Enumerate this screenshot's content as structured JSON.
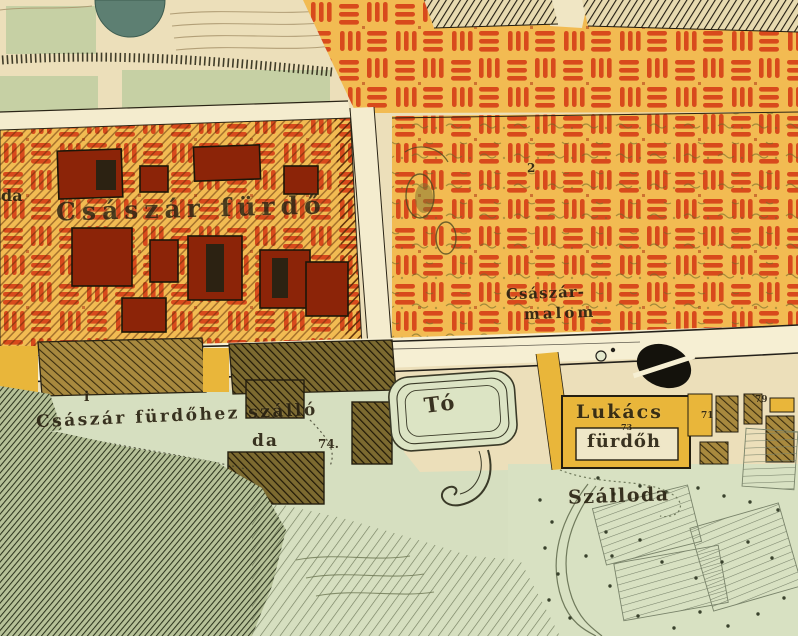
{
  "map": {
    "type": "historical-city-map",
    "labels": {
      "partial_left": "da",
      "csaszar_furdo": "Császár fürdő",
      "malom_line1": "Császár-",
      "malom_line2": "malom",
      "hotel_line1": "Császár fürdőhez szálló",
      "hotel_line2": "da",
      "hotel_parcel_number": "74.",
      "pond": "Tó",
      "lukacs_line1": "Lukács",
      "lukacs_line2": "fürdőh",
      "lukacs_parcel_number": "73",
      "szalloda": "Szálloda",
      "parcel_number_2": "2",
      "parcel_number_71": "71",
      "parcel_number_79": "79",
      "info_marker": "i"
    },
    "colors": {
      "paper": "#ecdfba",
      "field_green": "#c6d0a4",
      "lowland_green": "#d8e1c2",
      "pond_teal": "#5d7f72",
      "vineyard_orange": "#f2bb52",
      "vine_dash_red": "#d84a1c",
      "building_red": "#8c2408",
      "road_cream": "#f6efd3",
      "highlight_yellow": "#e9b63a",
      "ink_black": "#221c10",
      "hachure_green": "#2d351e",
      "contour_brown": "#a8946c"
    },
    "symbols": {
      "road_marker": "slashed-oval-ink-symbol",
      "pond_symbol": "concentric-rounded-rectangles",
      "vineyard_symbol": "red-dash-clusters",
      "hill_symbol": "diagonal-hachure"
    }
  }
}
